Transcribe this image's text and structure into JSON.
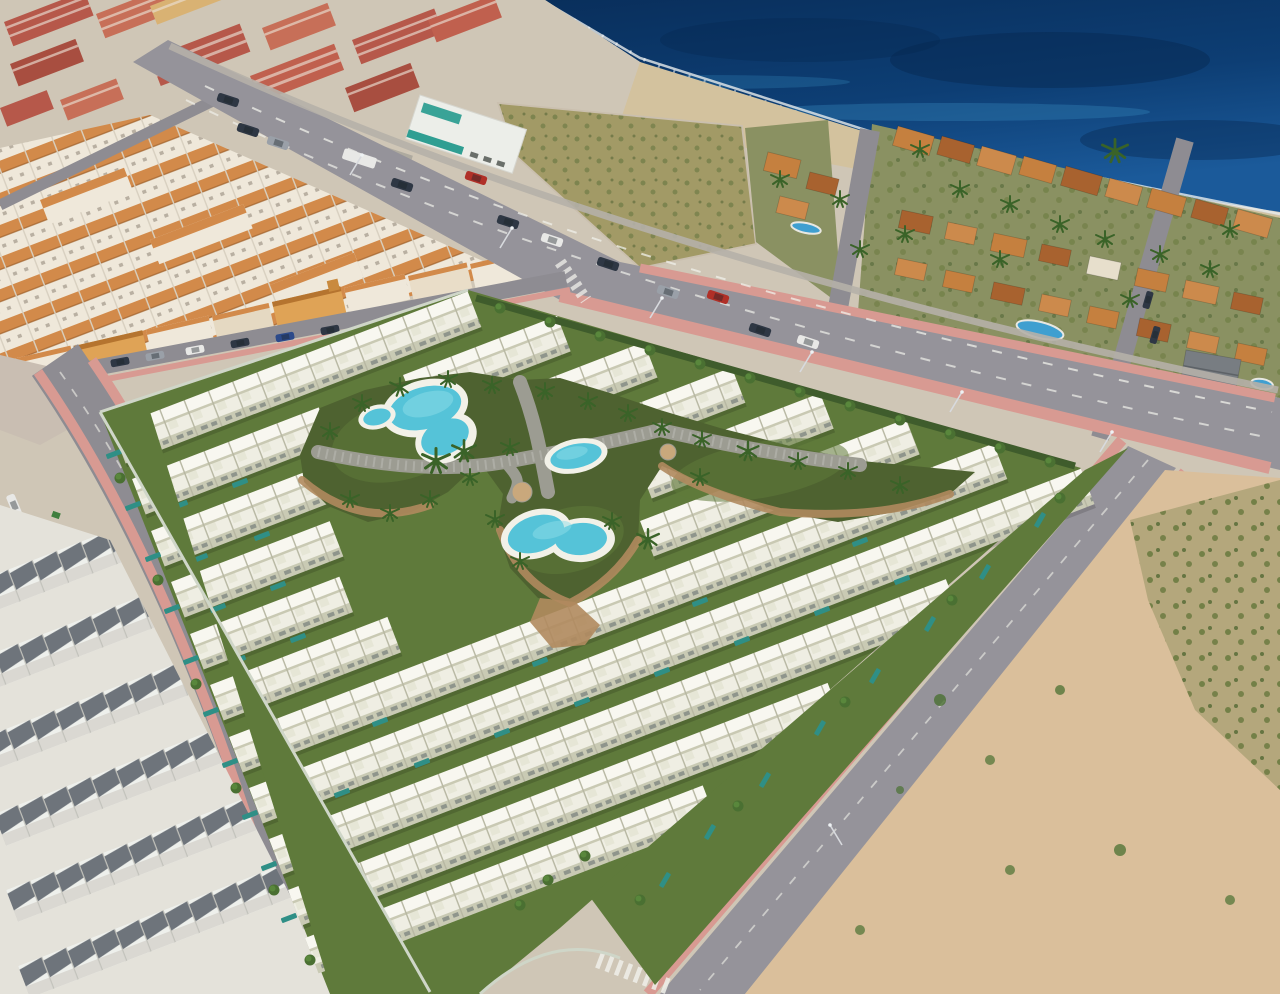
{
  "meta": {
    "type": "aerial-photograph",
    "subject": "oblique aerial photo of a coastal town with a rendered new-build townhouse development beside the sea",
    "width": 1280,
    "height": 994
  },
  "palette": {
    "sea_dark": "#092f5c",
    "sea_deep": "#0d3e74",
    "sea_mid": "#1b5a9a",
    "sea_shallow": "#2e7bb0",
    "surf": "#e9ecec",
    "beach_sand": "#d3c29e",
    "rock": "#8a7c66",
    "scrub_base": "#a29a66",
    "scrub_speckle": "#77804b",
    "sand_lot": "#dabf9b",
    "bush": "#6d7c42",
    "bush_dark": "#55693a",
    "asphalt": "#95939a",
    "town_road": "#8e8c92",
    "sidewalk_pink": "#d89a92",
    "lane_white": "#f0f0ea",
    "town_base": "#cfc6b6",
    "red_a": "#b6584a",
    "red_b": "#c76f58",
    "red_c": "#a84e40",
    "red_d": "#c0604e",
    "cream": "#d9b273",
    "roof_orange": "#d28a4a",
    "town_white": "#efe8da",
    "market_white": "#eceee9",
    "market_teal": "#2f9e92",
    "dev_white": "#efeee3",
    "dev_roof": "#f8f7f0",
    "dev_front": "#c9cab4",
    "dev_gap": "#b7b7a2",
    "lawn": "#5f7a3b",
    "garden_grass": "#4e6230",
    "hedge": "#3f5c2c",
    "tree": "#4a7032",
    "palm": "#3a6328",
    "path": "#9c9c92",
    "dirt": "#b08a5e",
    "planter": "#c9a87c",
    "pool_water": "#55c3d8",
    "pool_water_hi": "#8edde8",
    "pool_deck": "#f2f1e8",
    "lap_pool": "#2f8f86",
    "villa_base": "#8a9162",
    "villa_roof_a": "#c5803f",
    "villa_roof_b": "#a8622f",
    "villa_roof_c": "#cc8a4c",
    "villa_white": "#e7dfcc",
    "gray_roof": "#787d82",
    "old_white": "#eef0ec",
    "old_roof": "#6e747b",
    "wall": "#cfd6c8",
    "car_dark": "#2e3744",
    "car_silver": "#9aa0a8",
    "car_white": "#e8e8e6",
    "car_red": "#b03028",
    "car_navy": "#2c4a8a"
  },
  "scene": {
    "sea": {
      "label": "deep-blue-sea"
    },
    "beach": {
      "label": "rocky-beach-strip"
    },
    "old_town": {
      "label": "old-town-terraced-houses-with-orange-roofs",
      "apartment_blocks": 12
    },
    "supermarket": {
      "label": "white-commercial-building-with-teal-sign"
    },
    "fenced_lot": {
      "label": "fenced-vacant-scrub-plot-by-beach"
    },
    "villas": {
      "label": "seafront-villa-district",
      "swimming_pools": 3
    },
    "avenue": {
      "label": "wide-coastal-avenue",
      "vehicles": 13,
      "bus": 1
    },
    "development": {
      "label": "rendered-new-townhouse-development",
      "house_rows": 12,
      "communal_pools": [
        {
          "shape": "kidney"
        },
        {
          "shape": "pond"
        },
        {
          "shape": "oval"
        },
        {
          "shape": "heart"
        }
      ],
      "private_lap_pools": true,
      "central_garden": "lawns-palms-paved-paths"
    },
    "sandy_lot": {
      "label": "undeveloped-sandy-plot-with-scrub"
    },
    "streets": {
      "west": "residential-street-with-parked-cars",
      "northwest": "town-boundary-street",
      "southeast": "perimeter-street-with-zebra-crossing-and-arrows"
    }
  }
}
